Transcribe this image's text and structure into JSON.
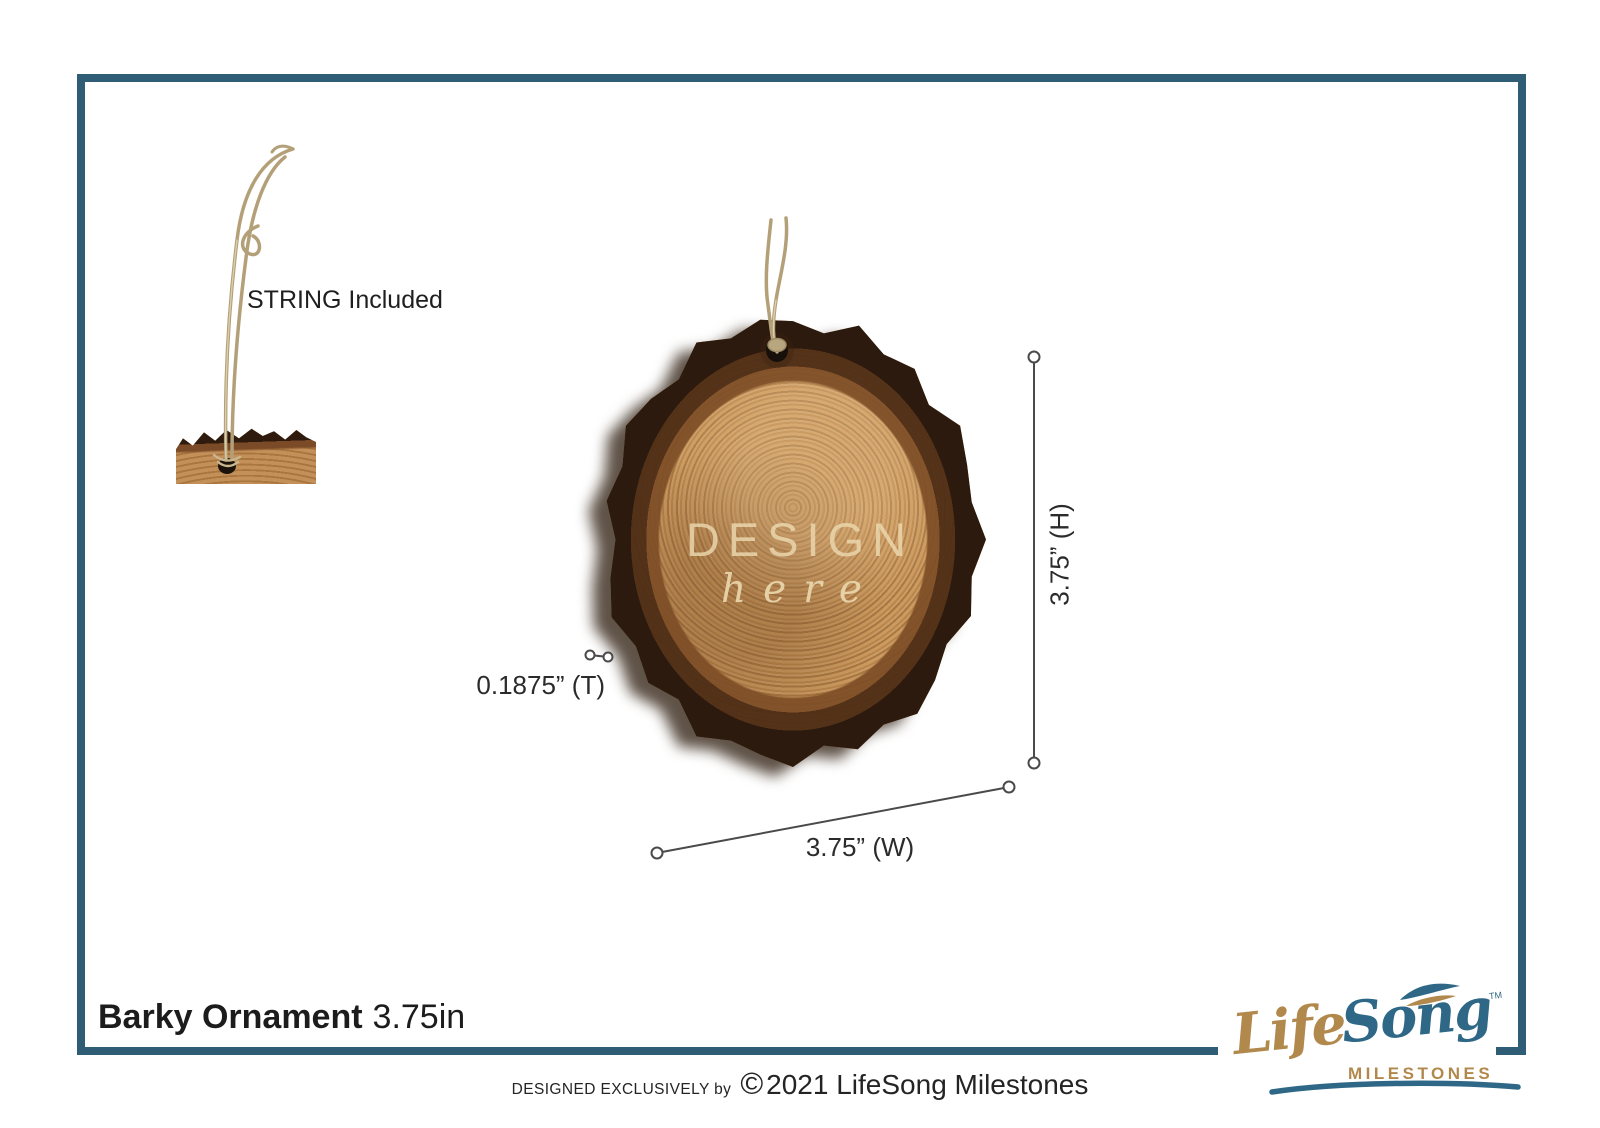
{
  "page": {
    "frame_color": "#2e5d75",
    "background": "#ffffff"
  },
  "string_callout": {
    "label": "STRING Included"
  },
  "ornament": {
    "watermark_line1": "DESIGN",
    "watermark_line2": "here",
    "wood_color": "#c49258",
    "bark_color": "#2b1a0d",
    "twine_color": "#b3a078"
  },
  "dimensions": {
    "height_label": "3.75” (H)",
    "width_label": "3.75” (W)",
    "thickness_label": "0.1875” (T)"
  },
  "title": {
    "name": "Barky Ornament",
    "size": "3.75in"
  },
  "footer": {
    "prefix": "DESIGNED EXCLUSIVELY by",
    "copyright_symbol": "©",
    "text": "2021 LifeSong Milestones"
  },
  "logo": {
    "word1": "Life",
    "word2": "Song",
    "tm": "TM",
    "sub": "MILESTONES",
    "gold": "#b1894c",
    "teal": "#2e6886"
  }
}
